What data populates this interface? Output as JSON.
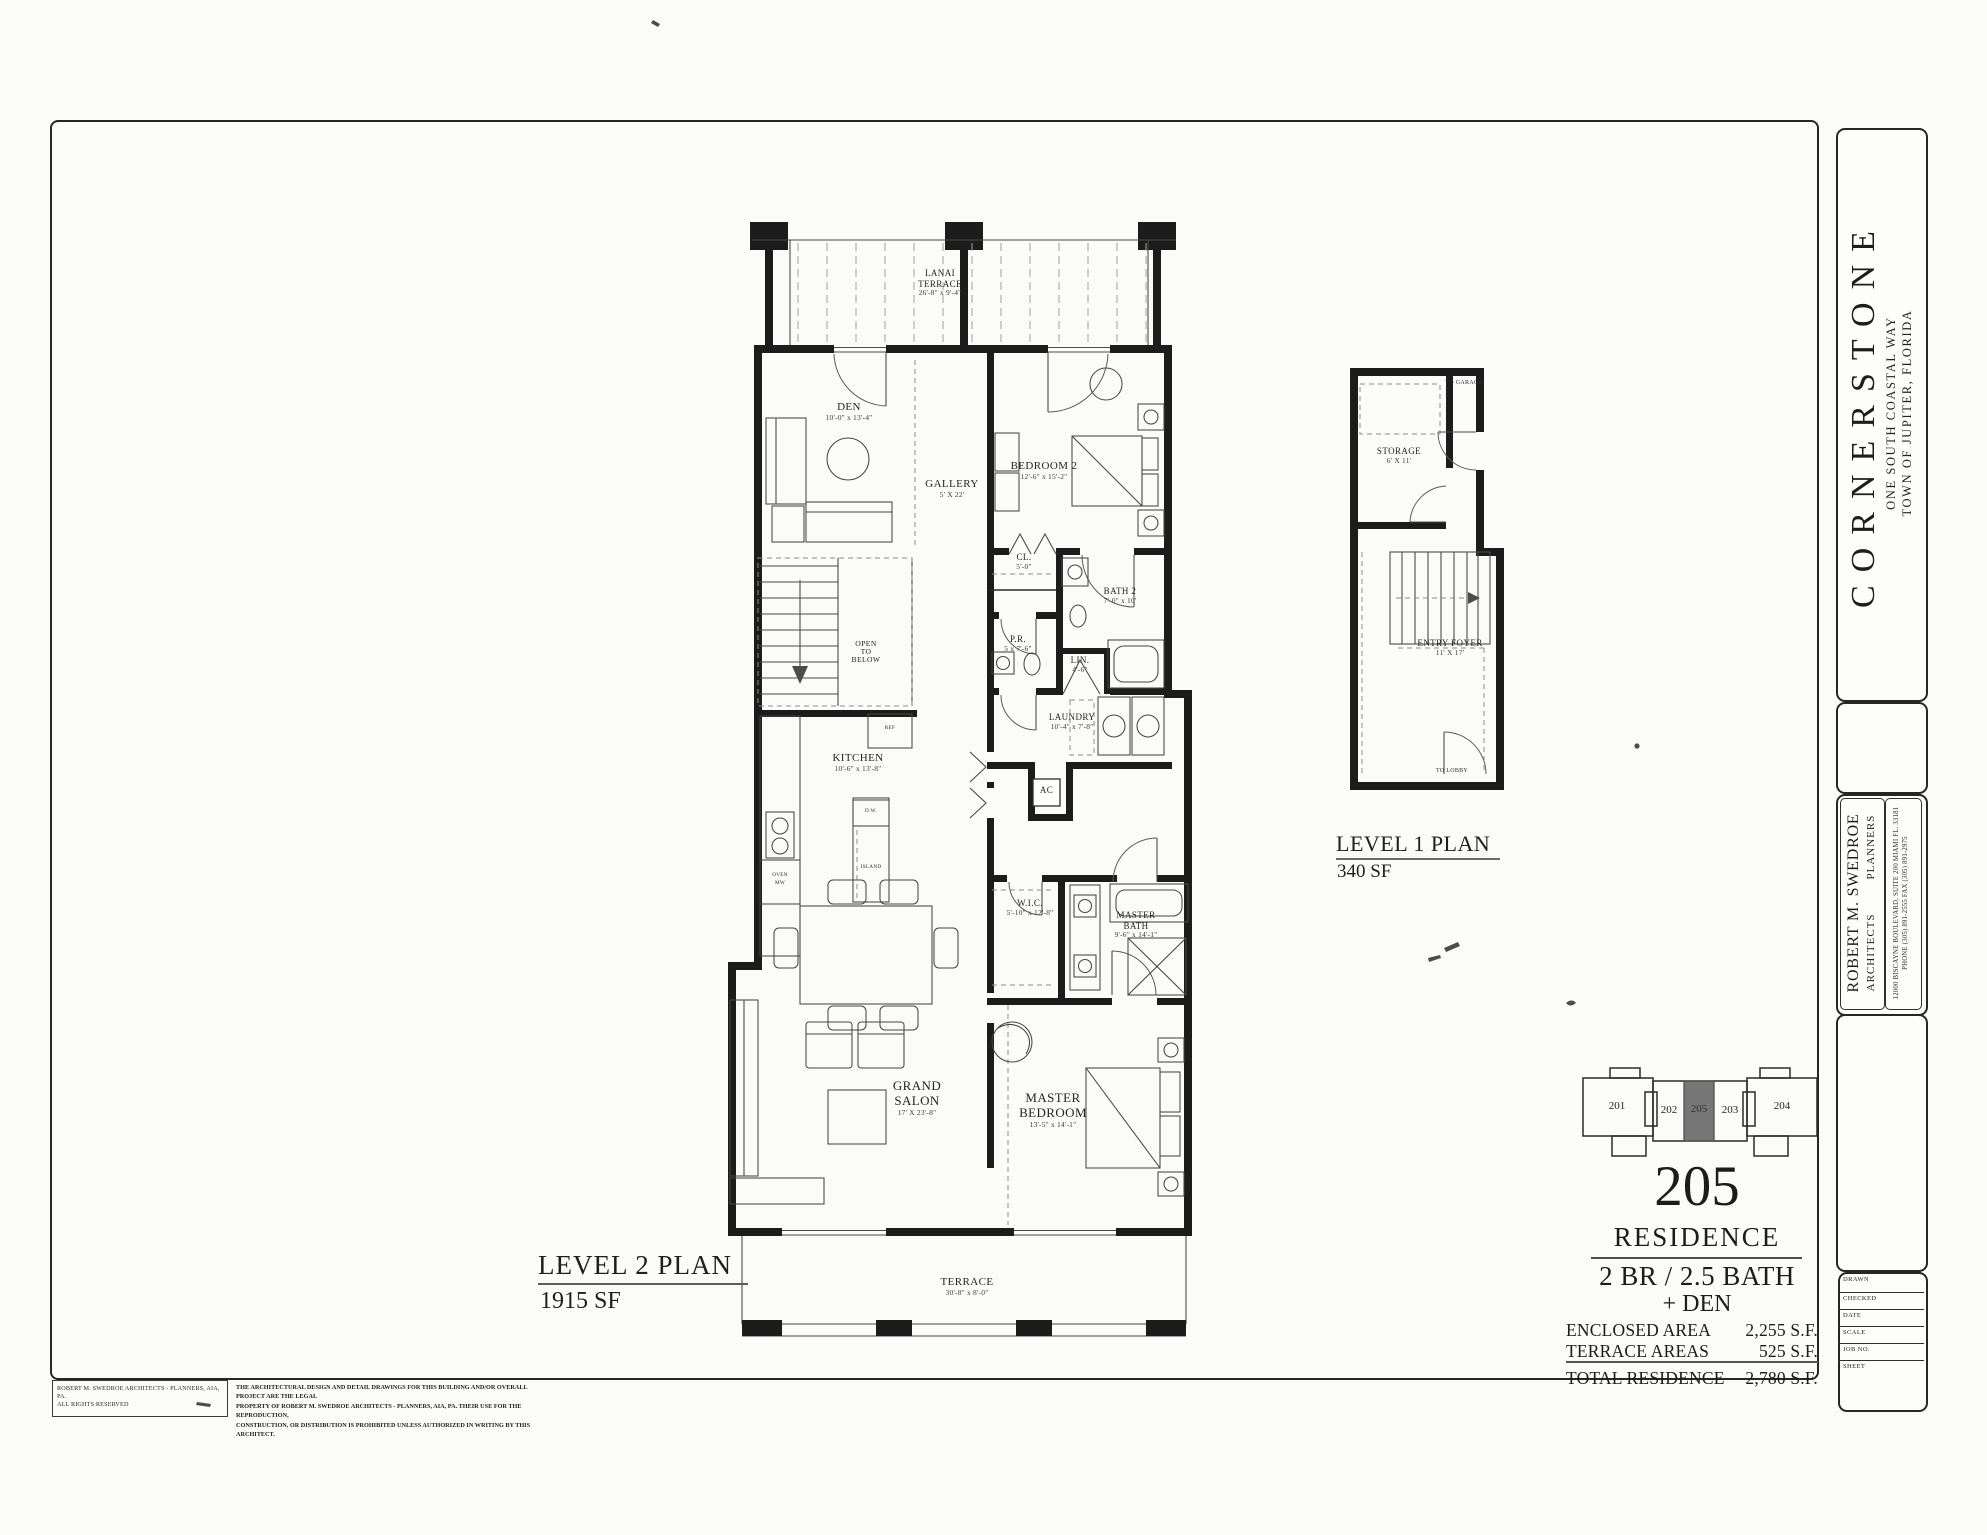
{
  "sheet": {
    "project_name": "CORNERSTONE",
    "project_address_line1": "ONE SOUTH COASTAL WAY",
    "project_address_line2": "TOWN  OF  JUPITER,   FLORIDA",
    "architect_name": "ROBERT M. SWEDROE",
    "architect_title1": "ARCHITECTS",
    "architect_title2": "PLANNERS",
    "architect_office_line1": "12000 BISCAYNE BOULEVARD, SUITE 200      MIAMI FL. 33181",
    "architect_office_line2": "PHONE  (305) 891-2555            FAX  (305) 891-2975",
    "fields": {
      "drawn": "DRAWN",
      "checked": "CHECKED",
      "date": "DATE",
      "scale": "SCALE",
      "job_no": "JOB  NO.",
      "sheet": "SHEET"
    }
  },
  "level2": {
    "title": "LEVEL 2 PLAN",
    "area": "1915 SF",
    "rooms": {
      "lanai": {
        "name1": "LANAI",
        "name2": "TERRACE",
        "dim": "26'-8\" x 9'-4\""
      },
      "den": {
        "name1": "DEN",
        "dim": "10'-0\" x 13'-4\""
      },
      "gallery": {
        "name1": "GALLERY",
        "dim": "5' X 22'"
      },
      "bedroom2": {
        "name1": "BEDROOM 2",
        "dim": "12'-6\" x 15'-2\""
      },
      "closet": {
        "name1": "CL.",
        "dim": "5'-0\""
      },
      "bath2": {
        "name1": "BATH 2",
        "dim": "7'-0\" x 10'"
      },
      "powder": {
        "name1": "P.R.",
        "dim": "5 x 7'-6\""
      },
      "linen": {
        "name1": "LIN.",
        "dim": "4'-6\""
      },
      "laundry": {
        "name1": "LAUNDRY",
        "dim": "10'-4\" x 7'-8\""
      },
      "open_below": {
        "name1": "OPEN",
        "name2": "TO",
        "name3": "BELOW"
      },
      "kitchen": {
        "name1": "KITCHEN",
        "dim": "10'-6\" x 13'-8\""
      },
      "ac": {
        "name1": "AC"
      },
      "wic": {
        "name1": "W.I.C.",
        "dim": "5'-10\" x 12'-8\""
      },
      "master_bath": {
        "name1": "MASTER",
        "name2": "BATH",
        "dim": "9'-6\" x 14'-1\""
      },
      "grand_salon": {
        "name1": "GRAND",
        "name2": "SALON",
        "dim": "17' X 23'-8\""
      },
      "master_bedroom": {
        "name1": "MASTER",
        "name2": "BEDROOM",
        "dim": "13'-5\" x 14'-1\""
      },
      "terrace": {
        "name1": "TERRACE",
        "dim": "30'-8\" x 8'-0\""
      }
    },
    "annotations": {
      "ref": "REF",
      "dw": "D.W.",
      "island": "ISLAND",
      "oven1": "OVEN",
      "oven2": "MW"
    }
  },
  "level1": {
    "title": "LEVEL 1 PLAN",
    "area": "340 SF",
    "rooms": {
      "storage": {
        "name1": "STORAGE",
        "dim": "6' X 11'"
      },
      "entry_foyer": {
        "name1": "ENTRY FOYER",
        "dim": "11' X 17'"
      }
    },
    "annotations": {
      "to_garage": "TO GARAGE",
      "to_lobby": "TO LOBBY"
    }
  },
  "unit": {
    "number_large": "205",
    "residence_label": "RESIDENCE",
    "config_line1": "2 BR / 2.5 BATH",
    "config_line2": "+ DEN",
    "area_rows": [
      {
        "label": "ENCLOSED AREA",
        "value": "2,255 S.F."
      },
      {
        "label": "TERRACE AREAS",
        "value": "525 S.F."
      }
    ],
    "total_row": {
      "label": "TOTAL RESIDENCE",
      "value": "2,780 S.F."
    },
    "locator_units": [
      {
        "id": "201"
      },
      {
        "id": "202"
      },
      {
        "id": "205"
      },
      {
        "id": "203"
      },
      {
        "id": "204"
      }
    ]
  },
  "disclaimer": {
    "left_line1": "ROBERT M. SWEDROE ARCHITECTS - PLANNERS, AIA, PA.",
    "left_line2": "ALL RIGHTS RESERVED",
    "right_line1": "THE ARCHITECTURAL DESIGN AND DETAIL DRAWINGS FOR THIS BUILDING AND/OR OVERALL PROJECT ARE THE LEGAL",
    "right_line2": "PROPERTY OF ROBERT M. SWEDROE ARCHITECTS - PLANNERS, AIA, PA.  THEIR USE FOR THE REPRODUCTION,",
    "right_line3": "CONSTRUCTION, OR DISTRIBUTION IS PROHIBITED UNLESS AUTHORIZED IN WRITING BY THIS ARCHITECT."
  },
  "colors": {
    "ink": "#212121",
    "wall": "#1c1c1c",
    "highlight_fill": "#777777",
    "paper": "#fbfbfa"
  }
}
